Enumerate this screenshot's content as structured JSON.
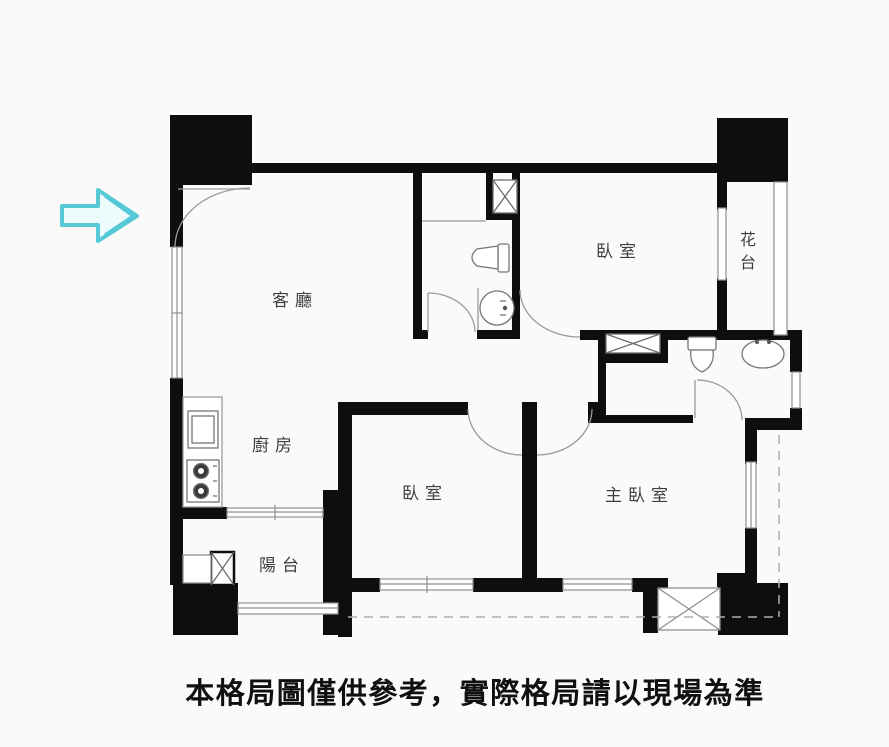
{
  "floor_plan": {
    "labels": {
      "living_room": "客廳",
      "kitchen": "廚房",
      "balcony": "陽台",
      "bedroom_top_right": "臥室",
      "bedroom_bottom": "臥室",
      "master_bedroom": "主臥室",
      "flower_stand": "花台"
    },
    "caption": "本格局圖僅供參考，實際格局請以現場為準",
    "colors": {
      "wall": "#0e0e0e",
      "thin_line": "#8f8f8f",
      "door_arc": "#9a9a9a",
      "arrow_stroke": "#55c9d6",
      "arrow_fill": "#eefbfd",
      "background": "#fafaf9",
      "caption_text": "#101010",
      "label_text": "#3f3f3f"
    },
    "icons": {
      "entrance_arrow": "right-arrow-icon",
      "pipe_shafts": "x-box-icon",
      "fixtures": [
        "toilet-icon",
        "round-sink-icon",
        "oval-sink-icon",
        "stove-icon",
        "kitchen-sink-icon"
      ]
    }
  }
}
